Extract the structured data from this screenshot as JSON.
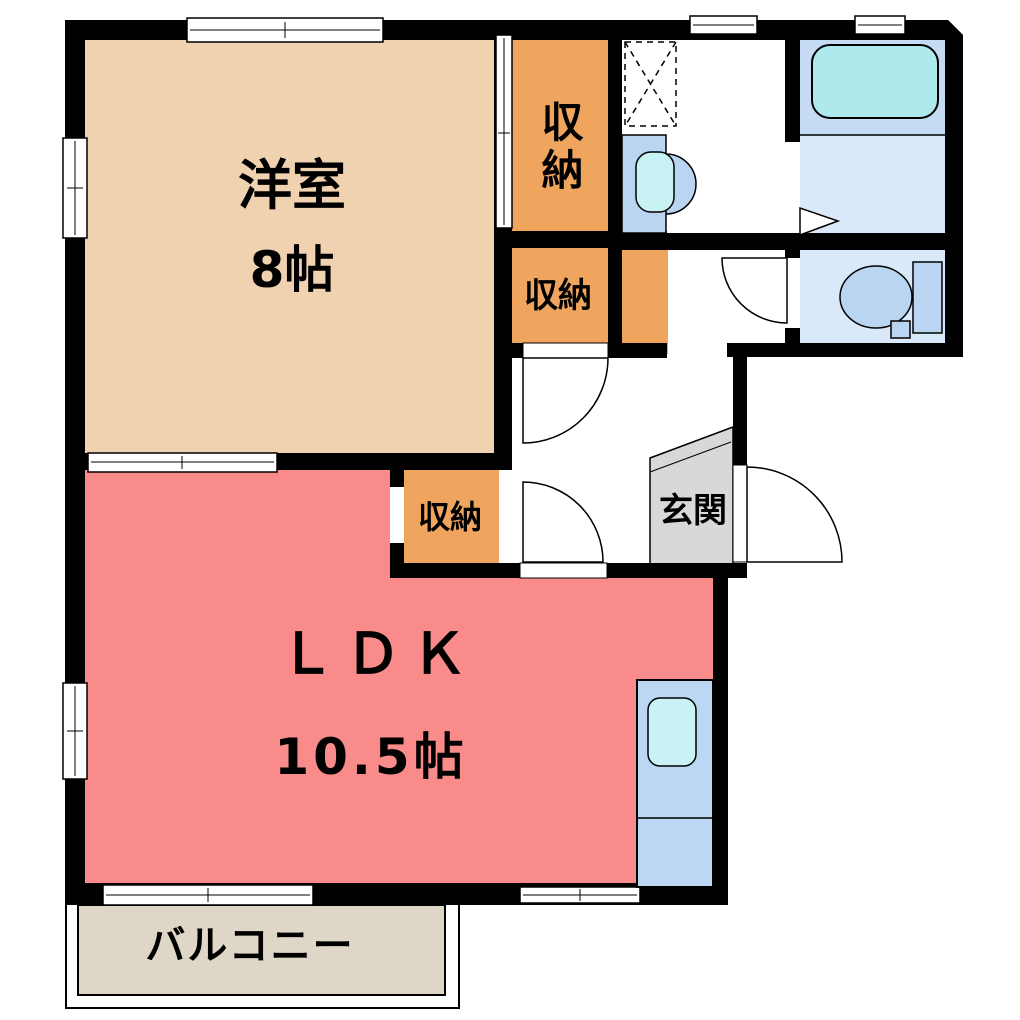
{
  "plan": {
    "title": "1LDK floor plan",
    "rooms": {
      "western_room": {
        "name": "洋室",
        "size": "8帖"
      },
      "ldk": {
        "name": "ＬＤＫ",
        "size": "10.5帖"
      },
      "closet1": {
        "name": "収納"
      },
      "closet2": {
        "name": "収納"
      },
      "closet3": {
        "name": "収納"
      },
      "entrance": {
        "name": "玄関"
      },
      "balcony": {
        "name": "バルコニー"
      }
    },
    "colors": {
      "wall": "#000000",
      "western_room_fill": "#F0D2B0",
      "closet_fill": "#F0A55F",
      "ldk_fill": "#F98B8B",
      "bath_upper_fill": "#C5DBF4",
      "bath_lower_fill": "#DAE9F9",
      "toilet_room_fill": "#DAE9F9",
      "tub_fill": "#AEE9EE",
      "fixture_fill": "#B9D5F1",
      "kitchen_counter_fill": "#BBD7F3",
      "sink_fill": "#C9F2F4",
      "entrance_fill": "#D8D8D8",
      "balcony_fill": "#DED7C8"
    }
  }
}
